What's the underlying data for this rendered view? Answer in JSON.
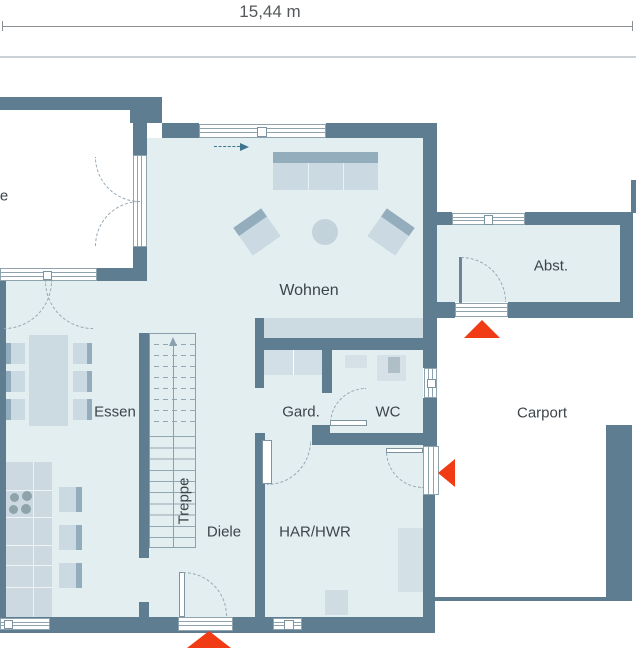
{
  "dimension": {
    "label": "15,44 m"
  },
  "rooms": {
    "terrace_partial": {
      "label": "e"
    },
    "wohnen": {
      "label": "Wohnen"
    },
    "essen": {
      "label": "Essen"
    },
    "treppe": {
      "label": "Treppe"
    },
    "diele": {
      "label": "Diele"
    },
    "garderobe": {
      "label": "Gard."
    },
    "wc": {
      "label": "WC"
    },
    "har_hwr": {
      "label": "HAR/HWR"
    },
    "abstellraum": {
      "label": "Abst."
    },
    "carport": {
      "label": "Carport"
    }
  },
  "entrance_markers": [
    {
      "location": "abstellraum-exterior-door",
      "direction": "up"
    },
    {
      "location": "house-entrance-from-carport",
      "direction": "left"
    },
    {
      "location": "front-door-bottom",
      "direction": "up"
    }
  ],
  "annotations": {
    "stair_direction": "up-arrow",
    "flow_arrow": "right-arrow"
  },
  "colors": {
    "wall": "#5f7d90",
    "floor": "#e3eef0",
    "furniture_light": "#cbdae2",
    "furniture_dark": "#93adbc",
    "accent_red": "#f03b15",
    "dimension_line": "#8a8f93"
  }
}
